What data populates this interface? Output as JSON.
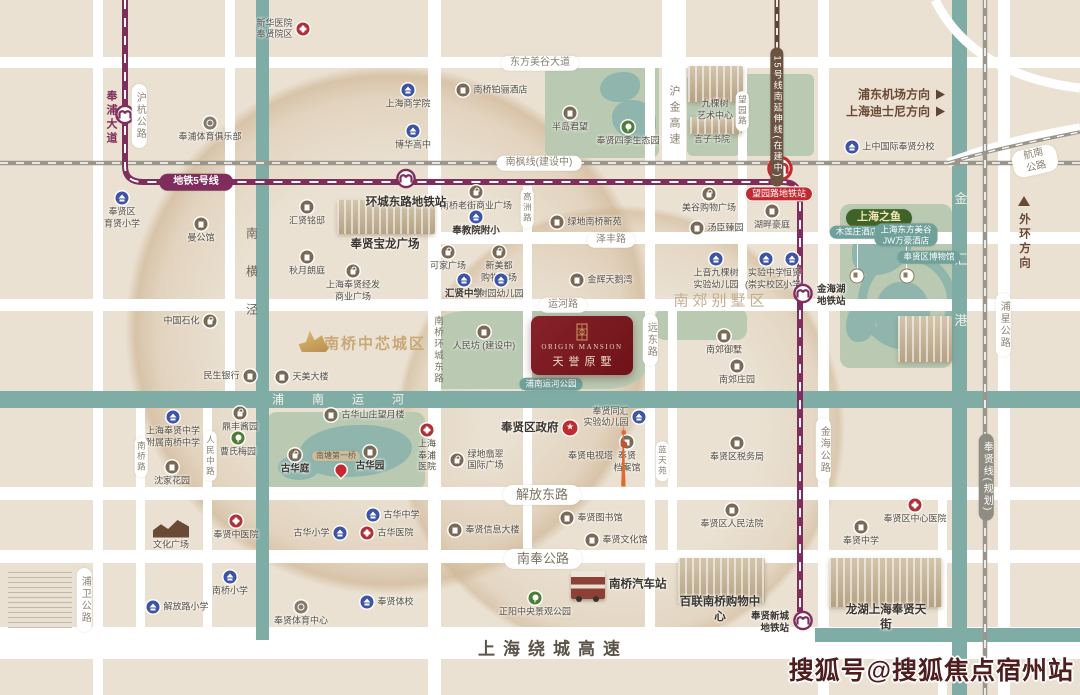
{
  "watermark": "搜狐号@搜狐焦点宿州站",
  "project": {
    "en": "ORIGIN MANSION",
    "cn": "天誉原墅"
  },
  "colors": {
    "background": "#EAE1D2",
    "road": "#FFFFFF",
    "canal": "#7FACA5",
    "park": "#B9C9B2",
    "metro_line5": "#7E2D5C",
    "metro_line15": "#5F4537",
    "railway": "#9A968C",
    "station_red": "#C3292F",
    "project_red": "#7A161D",
    "school_blue": "#3D53A4",
    "poi_brown": "#7A6A55",
    "hospital_red": "#B03038",
    "park_green": "#4E7D3A"
  },
  "map": {
    "directions": [
      {
        "t": "浦东机场方向",
        "x": 945,
        "y": 94
      },
      {
        "t": "上海迪士尼方向",
        "x": 945,
        "y": 111
      }
    ],
    "bigs": [
      {
        "t": "上海绕城高速",
        "x": 553,
        "y": 647,
        "c": "highway"
      },
      {
        "t": "南郊别墅区",
        "x": 721,
        "y": 300,
        "c": "district"
      },
      {
        "t": "南桥中芯城区",
        "x": 375,
        "y": 343,
        "c": "core"
      },
      {
        "t": "南横泾",
        "x": 252,
        "y": 284,
        "c": "canal-d"
      },
      {
        "t": "金汇港",
        "x": 960,
        "y": 283,
        "c": "canal-w"
      },
      {
        "t": "浦南运河",
        "x": 352,
        "y": 399,
        "c": "canal-wh"
      },
      {
        "t": "奉浦大道",
        "x": 111,
        "y": 118,
        "c": "metro-t"
      },
      {
        "t": "沪金高速",
        "x": 674,
        "y": 117,
        "c": "road-t"
      },
      {
        "t": "南桥环城东路",
        "x": 437,
        "y": 350,
        "c": "road-t2"
      },
      {
        "t": "外环方向",
        "x": 1024,
        "y": 242,
        "c": "dirv"
      }
    ],
    "pills": [
      {
        "t": "东方美谷大道",
        "x": 540,
        "y": 63
      },
      {
        "t": "南枫线(建设中)",
        "x": 539,
        "y": 163
      },
      {
        "t": "航南公路",
        "x": 1035,
        "y": 161,
        "rot": -13
      },
      {
        "t": "泽丰路",
        "x": 611,
        "y": 240
      },
      {
        "t": "运河路",
        "x": 563,
        "y": 305
      },
      {
        "t": "解放东路",
        "x": 542,
        "y": 495,
        "s": "road-lg"
      },
      {
        "t": "南奉公路",
        "x": 543,
        "y": 559,
        "s": "road-lg"
      },
      {
        "t": "地铁5号线",
        "x": 196,
        "y": 182,
        "s": "metro"
      },
      {
        "t": "望园路地铁站",
        "x": 779,
        "y": 194,
        "s": "red"
      },
      {
        "t": "15号线南延伸线(在建中)",
        "x": 777,
        "y": 117,
        "s": "line15",
        "v": 1
      },
      {
        "t": "沪杭公路",
        "x": 139,
        "y": 116,
        "v": 1
      },
      {
        "t": "高洲路",
        "x": 527,
        "y": 208,
        "s": "road-sm",
        "v": 1
      },
      {
        "t": "望园路",
        "x": 742,
        "y": 111,
        "s": "road-sm",
        "v": 1
      },
      {
        "t": "远东路",
        "x": 650,
        "y": 340,
        "v": 1
      },
      {
        "t": "蓝天苑",
        "x": 662,
        "y": 461,
        "s": "road-sm",
        "v": 1
      },
      {
        "t": "金海公路",
        "x": 823,
        "y": 450,
        "v": 1
      },
      {
        "t": "浦星公路",
        "x": 1003,
        "y": 325,
        "v": 1
      },
      {
        "t": "奉贤线(规划)",
        "x": 986,
        "y": 477,
        "s": "gray",
        "v": 1
      },
      {
        "t": "浦卫公路",
        "x": 84,
        "y": 600,
        "v": 1
      },
      {
        "t": "南桥路",
        "x": 141,
        "y": 457,
        "s": "road-sm",
        "v": 1
      },
      {
        "t": "人民中路",
        "x": 210,
        "y": 456,
        "s": "road-sm",
        "v": 1
      },
      {
        "t": "上海之鱼",
        "x": 879,
        "y": 218,
        "s": "fish"
      },
      {
        "t": "木莲庄酒店",
        "x": 857,
        "y": 232,
        "s": "teal"
      },
      {
        "t": "上海东方美谷\nJW万豪酒店",
        "x": 906,
        "y": 235,
        "s": "teal"
      },
      {
        "t": "奉贤区博物馆",
        "x": 929,
        "y": 257,
        "s": "teal"
      },
      {
        "t": "南塘第一桥",
        "x": 336,
        "y": 456,
        "s": "tan"
      },
      {
        "t": "浦南运河公园",
        "x": 551,
        "y": 384,
        "s": "teal"
      }
    ],
    "pois": [
      {
        "k": "hosp",
        "x": 303,
        "y": 29,
        "l": "新华医院\n奉贤院区",
        "lp": "left"
      },
      {
        "k": "school",
        "x": 408,
        "y": 90,
        "l": "上海商学院",
        "lp": "below"
      },
      {
        "k": "sports",
        "x": 210,
        "y": 123,
        "l": "奉浦体育俱乐部",
        "lp": "below"
      },
      {
        "k": "school",
        "x": 413,
        "y": 131,
        "l": "博华高中",
        "lp": "below"
      },
      {
        "k": "hotel",
        "x": 463,
        "y": 90,
        "l": "南桥铂骊酒店",
        "lp": "right"
      },
      {
        "k": "res",
        "x": 570,
        "y": 113,
        "l": "半岛君望",
        "lp": "below"
      },
      {
        "k": "park",
        "x": 628,
        "y": 127,
        "l": "奉贤四季生态园",
        "lp": "below"
      },
      {
        "k": "school",
        "x": 122,
        "y": 198,
        "l": "奉贤区\n育贤小学",
        "lp": "below"
      },
      {
        "k": "res",
        "x": 201,
        "y": 224,
        "l": "曼公馆",
        "lp": "below"
      },
      {
        "k": "res",
        "x": 307,
        "y": 207,
        "l": "汇贤铭邸",
        "lp": "below"
      },
      {
        "k": "res",
        "x": 307,
        "y": 257,
        "l": "秋月朗庭",
        "lp": "below"
      },
      {
        "k": "shop",
        "x": 353,
        "y": 271,
        "l": "上海奉贤经发\n商业广场",
        "lp": "below"
      },
      {
        "k": "shop",
        "x": 476,
        "y": 192,
        "l": "南桥老街商业广场",
        "lp": "below"
      },
      {
        "k": "school",
        "x": 476,
        "y": 217,
        "l": "奉教院附小",
        "lp": "below",
        "b": 1
      },
      {
        "k": "res",
        "x": 557,
        "y": 222,
        "l": "绿地南桥新苑",
        "lp": "right"
      },
      {
        "k": "shop",
        "x": 709,
        "y": 194,
        "l": "美谷购物广场",
        "lp": "below"
      },
      {
        "k": "res",
        "x": 697,
        "y": 228,
        "l": "汤臣臻园",
        "lp": "right"
      },
      {
        "k": "res",
        "x": 772,
        "y": 211,
        "l": "湖畔豪庭",
        "lp": "below"
      },
      {
        "k": "kinder",
        "x": 716,
        "y": 259,
        "l": "上音九棵树\n实验幼儿园",
        "lp": "below"
      },
      {
        "k": "school",
        "x": 766,
        "y": 259,
        "l": "实验中学\n(崇实校区)",
        "lp": "below"
      },
      {
        "k": "school",
        "x": 792,
        "y": 259,
        "l": "恒贤\n小学",
        "lp": "below"
      },
      {
        "k": "school",
        "x": 852,
        "y": 147,
        "l": "上中国际奉贤分校",
        "lp": "right"
      },
      {
        "k": "shop",
        "x": 448,
        "y": 252,
        "l": "可家广场",
        "lp": "below"
      },
      {
        "k": "shop",
        "x": 499,
        "y": 252,
        "l": "新美都\n购物广场",
        "lp": "below"
      },
      {
        "k": "school",
        "x": 464,
        "y": 280,
        "l": "汇贤中学",
        "lp": "below",
        "b": 1
      },
      {
        "k": "kinder",
        "x": 501,
        "y": 280,
        "l": "树园幼儿园",
        "lp": "below"
      },
      {
        "k": "res",
        "x": 577,
        "y": 280,
        "l": "金辉天鹅湾",
        "lp": "right"
      },
      {
        "k": "res",
        "x": 484,
        "y": 332,
        "l": "人民坊 (建设中)",
        "lp": "below"
      },
      {
        "k": "shop",
        "x": 210,
        "y": 321,
        "l": "中国石化",
        "lp": "left"
      },
      {
        "k": "bank",
        "x": 250,
        "y": 376,
        "l": "民生银行",
        "lp": "left"
      },
      {
        "k": "gov",
        "x": 282,
        "y": 377,
        "l": "天美大楼",
        "lp": "right"
      },
      {
        "k": "landmark",
        "x": 313,
        "y": 339
      },
      {
        "k": "res",
        "x": 724,
        "y": 336,
        "l": "南郊御墅",
        "lp": "below"
      },
      {
        "k": "res",
        "x": 737,
        "y": 366,
        "l": "南郊庄园",
        "lp": "below"
      },
      {
        "k": "star",
        "x": 570,
        "y": 428,
        "l": "奉贤区政府",
        "lp": "left",
        "b": 1,
        "big": 1
      },
      {
        "k": "kinder",
        "x": 639,
        "y": 417,
        "l": "奉贤同汇\n实验幼儿园",
        "lp": "left"
      },
      {
        "k": "gov",
        "x": 627,
        "y": 442,
        "l": "奉贤\n档案馆",
        "lp": "below"
      },
      {
        "k": "tower",
        "x": 624,
        "y": 456,
        "l": "奉贤电视塔",
        "lp": "left"
      },
      {
        "k": "gov",
        "x": 737,
        "y": 443,
        "l": "奉贤区税务局",
        "lp": "below"
      },
      {
        "k": "shop",
        "x": 457,
        "y": 460,
        "l": "绿地翡翠\n国际广场",
        "lp": "right"
      },
      {
        "k": "hosp",
        "x": 427,
        "y": 430,
        "l": "上海\n奉浦\n医院",
        "lp": "below"
      },
      {
        "k": "res",
        "x": 331,
        "y": 415,
        "l": "古华山庄望月楼",
        "lp": "right"
      },
      {
        "k": "shop",
        "x": 240,
        "y": 413,
        "l": "鼎丰酱园",
        "lp": "below"
      },
      {
        "k": "park",
        "x": 238,
        "y": 438,
        "l": "曹氏梅园",
        "lp": "below"
      },
      {
        "k": "school",
        "x": 173,
        "y": 417,
        "l": "上海奉贤中学\n附属南桥中学",
        "lp": "below"
      },
      {
        "k": "res",
        "x": 172,
        "y": 467,
        "l": "沈家花园",
        "lp": "below"
      },
      {
        "k": "shop",
        "x": 295,
        "y": 455,
        "l": "古华庭",
        "lp": "below",
        "b": 1
      },
      {
        "k": "res",
        "x": 370,
        "y": 452,
        "l": "古华园",
        "lp": "below",
        "b": 1
      },
      {
        "k": "pin",
        "x": 341,
        "y": 470
      },
      {
        "k": "school",
        "x": 373,
        "y": 515,
        "l": "古华中学",
        "lp": "right"
      },
      {
        "k": "school",
        "x": 340,
        "y": 533,
        "l": "古华小学",
        "lp": "left"
      },
      {
        "k": "hosp",
        "x": 367,
        "y": 533,
        "l": "古华医院",
        "lp": "right"
      },
      {
        "k": "hosp",
        "x": 236,
        "y": 521,
        "l": "奉贤中医院",
        "lp": "below"
      },
      {
        "k": "culture",
        "x": 171,
        "y": 528,
        "l": "文化广场",
        "lp": "below"
      },
      {
        "k": "gov",
        "x": 455,
        "y": 530,
        "l": "奉贤信息大楼",
        "lp": "right"
      },
      {
        "k": "gov",
        "x": 567,
        "y": 518,
        "l": "奉贤图书馆",
        "lp": "right"
      },
      {
        "k": "gov",
        "x": 592,
        "y": 540,
        "l": "奉贤文化馆",
        "lp": "right"
      },
      {
        "k": "bus",
        "x": 588,
        "y": 585,
        "l": "南桥汽车站",
        "lp": "right",
        "b": 1,
        "big": 1
      },
      {
        "k": "park",
        "x": 535,
        "y": 598,
        "l": "正阳中央景观公园",
        "lp": "below"
      },
      {
        "k": "gov",
        "x": 732,
        "y": 510,
        "l": "奉贤区人民法院",
        "lp": "below"
      },
      {
        "k": "hosp",
        "x": 915,
        "y": 505,
        "l": "奉贤区中心医院",
        "lp": "below"
      },
      {
        "k": "gov",
        "x": 861,
        "y": 527,
        "l": "奉贤中学",
        "lp": "below"
      },
      {
        "k": "school",
        "x": 153,
        "y": 607,
        "l": "解放路小学",
        "lp": "right"
      },
      {
        "k": "school",
        "x": 230,
        "y": 577,
        "l": "南桥小学",
        "lp": "below"
      },
      {
        "k": "sports",
        "x": 301,
        "y": 607,
        "l": "奉贤体育中心",
        "lp": "below"
      },
      {
        "k": "school",
        "x": 367,
        "y": 602,
        "l": "奉贤体校",
        "lp": "right"
      },
      {
        "k": "metro",
        "x": 125,
        "y": 117
      },
      {
        "k": "metro",
        "x": 406,
        "y": 181,
        "l": "环城东路地铁站",
        "lp": "below",
        "b": 1,
        "big": 1
      },
      {
        "k": "metrored",
        "x": 780,
        "y": 171
      },
      {
        "k": "metro",
        "x": 803,
        "y": 296,
        "l": "金海湖\n地铁站",
        "lp": "right",
        "b": 1
      },
      {
        "k": "metro",
        "x": 803,
        "y": 623,
        "l": "奉贤新城\n地铁站",
        "lp": "left",
        "b": 1
      },
      {
        "k": "lakemark",
        "x": 857,
        "y": 276
      },
      {
        "k": "lakemark",
        "x": 907,
        "y": 276
      },
      {
        "k": "none",
        "x": 385,
        "y": 245,
        "l": "奉贤宝龙广场",
        "b": 1,
        "big": 1
      },
      {
        "k": "none",
        "x": 715,
        "y": 110,
        "l": "九棵树\n艺术中心"
      },
      {
        "k": "none",
        "x": 712,
        "y": 140,
        "l": "言子书院"
      },
      {
        "k": "none",
        "x": 720,
        "y": 610,
        "l": "百联南桥购物中心",
        "b": 1,
        "big": 1
      },
      {
        "k": "none",
        "x": 886,
        "y": 618,
        "l": "龙湖上海奉贤天街",
        "b": 1,
        "big": 1
      }
    ],
    "illus": [
      {
        "n": "baolong-mall-illustration",
        "x": 337,
        "y": 200,
        "w": 98,
        "h": 34
      },
      {
        "n": "jiukeshu-art-center-illustration",
        "x": 688,
        "y": 66,
        "w": 55,
        "h": 36
      },
      {
        "n": "yanzi-academy-illustration",
        "x": 690,
        "y": 117,
        "w": 52,
        "h": 17
      },
      {
        "n": "jw-marriott-illustration",
        "x": 898,
        "y": 316,
        "w": 54,
        "h": 46
      },
      {
        "n": "bailian-mall-illustration",
        "x": 678,
        "y": 558,
        "w": 87,
        "h": 45
      },
      {
        "n": "longhu-paradise-walk-illustration",
        "x": 829,
        "y": 558,
        "w": 113,
        "h": 49
      }
    ]
  }
}
